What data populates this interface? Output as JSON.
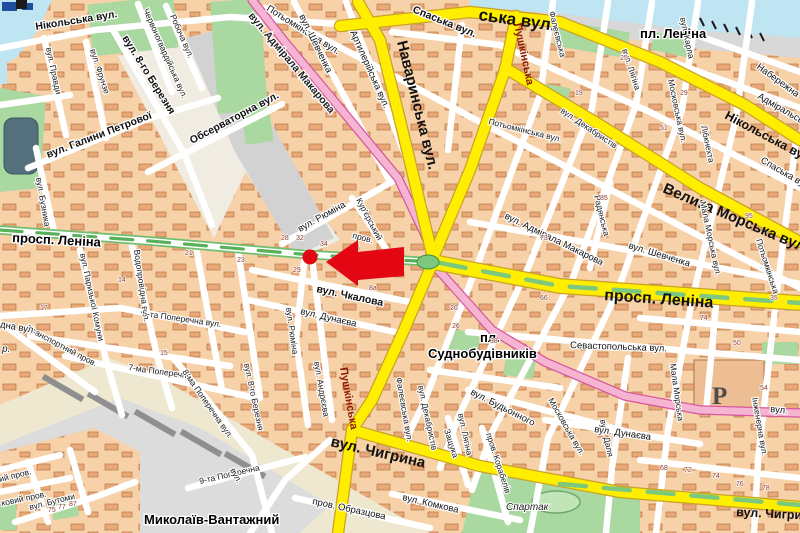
{
  "map_type": "city-street-map",
  "marker": {
    "kind": "red-dot-with-arrow",
    "color": "#E30613",
    "dot": {
      "x": 310,
      "y": 257,
      "r": 7.5
    },
    "arrow_tip": {
      "x": 326,
      "y": 262
    }
  },
  "colors": {
    "road_major": "#FFEE00",
    "road_major_casing": "#C9A227",
    "road_pink": "#F5B5D2",
    "road_pink_casing": "#D6579E",
    "median_green": "#7CC87C",
    "water": "#BFE4F2",
    "park": "#A9D9A0",
    "block": "#F7D1A8",
    "building": "#E8A877",
    "rail_area": "#DCDCDC",
    "marker": "#E30613"
  },
  "major_labels": {
    "navarynska": "Наваринська вул.",
    "nikolska_frag": "ська вул.",
    "nikolska_right": "Нікольська вул.",
    "velyka_morska": "Велика Морська вул.",
    "prospekt_left": "просп. Леніна",
    "prospekt_right": "просп. Леніна",
    "pl_lenina": "пл. Леніна",
    "pl_sudno_line1": "пл.",
    "pl_sudno_line2": "Суднобудівників",
    "chyhryna": "вул. Чигрина",
    "mykolaiv_vantazhnyi": "Миколаїв-Вантажний"
  },
  "labels": [
    {
      "id": "nikolska-left",
      "text": "Нікольська вул.",
      "x": 36,
      "y": 30,
      "r": -9,
      "c": "b"
    },
    {
      "id": "pravdy",
      "text": "вул. Правди",
      "x": 46,
      "y": 48,
      "r": 78,
      "c": "s"
    },
    {
      "id": "frunze",
      "text": "вул. Фрунзе",
      "x": 90,
      "y": 50,
      "r": 72,
      "c": "s"
    },
    {
      "id": "berezni8",
      "text": "вул. 8-го Березня",
      "x": 122,
      "y": 38,
      "r": 58,
      "c": "b"
    },
    {
      "id": "chervonohvardiiska",
      "text": "Червоногвардійська вул.",
      "x": 143,
      "y": 10,
      "r": 66,
      "c": "s"
    },
    {
      "id": "robocha",
      "text": "Робоча вул.",
      "x": 170,
      "y": 16,
      "r": 66,
      "c": "s"
    },
    {
      "id": "halyny-petrovoi",
      "text": "вул. Галини Петрової",
      "x": 48,
      "y": 158,
      "r": -21,
      "c": "b"
    },
    {
      "id": "observatorna",
      "text": "Обсерваторна вул.",
      "x": 192,
      "y": 144,
      "r": -28,
      "c": "b"
    },
    {
      "id": "makarova-1",
      "text": "вул. Адмірала Макарова",
      "x": 248,
      "y": 16,
      "r": 50,
      "c": "pink"
    },
    {
      "id": "riumina-1",
      "text": "вул. Рюміна",
      "x": 300,
      "y": 232,
      "r": -29,
      "c": "m"
    },
    {
      "id": "kurierskyi",
      "text": "Кур'єрський",
      "x": 356,
      "y": 200,
      "r": 62,
      "c": "s"
    },
    {
      "id": "kurierskyi-prov",
      "text": "пров.",
      "x": 352,
      "y": 238,
      "r": 14,
      "c": "s"
    },
    {
      "id": "chkalova",
      "text": "вул. Чкалова",
      "x": 316,
      "y": 292,
      "r": 12,
      "c": "b"
    },
    {
      "id": "potyomkinska-nw",
      "text": "Потьомкінська вул.",
      "x": 266,
      "y": 10,
      "r": 32,
      "c": "m"
    },
    {
      "id": "shevchenka-1",
      "text": "вул. Шевченка",
      "x": 299,
      "y": 16,
      "r": 64,
      "c": "m"
    },
    {
      "id": "artyleriiska",
      "text": "Артилерійська вул.",
      "x": 350,
      "y": 32,
      "r": 66,
      "c": "m"
    },
    {
      "id": "spaska-1",
      "text": "Спаська вул.",
      "x": 412,
      "y": 12,
      "r": 22,
      "c": "b"
    },
    {
      "id": "pushkinska-n",
      "text": "Пушкінська",
      "x": 514,
      "y": 24,
      "r": 78,
      "c": "red"
    },
    {
      "id": "faleievska-1",
      "text": "Фалеєвська",
      "x": 549,
      "y": 12,
      "r": 76,
      "c": "s"
    },
    {
      "id": "liahina-1",
      "text": "вул. Лягіна",
      "x": 622,
      "y": 50,
      "r": 72,
      "c": "s"
    },
    {
      "id": "dekabrystiv-1",
      "text": "вул. Декабристів",
      "x": 560,
      "y": 112,
      "r": 34,
      "c": "s"
    },
    {
      "id": "moskovska-1",
      "text": "Московська вул.",
      "x": 668,
      "y": 80,
      "r": 78,
      "c": "s"
    },
    {
      "id": "karla",
      "text": "вул. Карла",
      "x": 680,
      "y": 18,
      "r": 78,
      "c": "s"
    },
    {
      "id": "libknekhta",
      "text": "Лібкнехта",
      "x": 701,
      "y": 126,
      "r": 78,
      "c": "s"
    },
    {
      "id": "naberezhna",
      "text": "Набережна",
      "x": 756,
      "y": 68,
      "r": 36,
      "c": "m"
    },
    {
      "id": "admiralska",
      "text": "Адміральська",
      "x": 757,
      "y": 98,
      "r": 30,
      "c": "m"
    },
    {
      "id": "spaska-r",
      "text": "Спаська вул.",
      "x": 760,
      "y": 162,
      "r": 30,
      "c": "m"
    },
    {
      "id": "potyomkinska-mid",
      "text": "Потьомкінська вул.",
      "x": 488,
      "y": 124,
      "r": 14,
      "c": "s"
    },
    {
      "id": "potyomkinska-r",
      "text": "Потьомкінська",
      "x": 756,
      "y": 240,
      "r": 72,
      "c": "s"
    },
    {
      "id": "radianska",
      "text": "Радянська",
      "x": 594,
      "y": 196,
      "r": 76,
      "c": "s"
    },
    {
      "id": "shevchenka-2",
      "text": "вул. Шевченка",
      "x": 628,
      "y": 248,
      "r": 17,
      "c": "m"
    },
    {
      "id": "makarova-2",
      "text": "вул. Адмірала Макарова",
      "x": 504,
      "y": 218,
      "r": 26,
      "c": "m"
    },
    {
      "id": "mala-morska-1",
      "text": "Мала Морська вул.",
      "x": 700,
      "y": 202,
      "r": 78,
      "c": "s"
    },
    {
      "id": "sevastopolska",
      "text": "Севастопольська вул.",
      "x": 570,
      "y": 348,
      "r": 2,
      "c": "m"
    },
    {
      "id": "vodoprovidna",
      "text": "Водопровідна вул.",
      "x": 134,
      "y": 250,
      "r": 82,
      "c": "s"
    },
    {
      "id": "paryzkoi-komuny",
      "text": "вул. Паризької Комуни",
      "x": 80,
      "y": 254,
      "r": 78,
      "c": "s"
    },
    {
      "id": "buznyka",
      "text": "вул. Бузника",
      "x": 36,
      "y": 178,
      "r": 80,
      "c": "s"
    },
    {
      "id": "riumina-2",
      "text": "вул. Рюміна",
      "x": 286,
      "y": 308,
      "r": 82,
      "c": "s"
    },
    {
      "id": "dunaieva-1",
      "text": "вул. Дунаєва",
      "x": 300,
      "y": 314,
      "r": 13,
      "c": "m"
    },
    {
      "id": "transportnyi",
      "text": "Транспортний пров.",
      "x": 26,
      "y": 330,
      "r": 28,
      "c": "s"
    },
    {
      "id": "zakhidna",
      "text": "Західна вул.",
      "x": -18,
      "y": 324,
      "r": 10,
      "c": "m"
    },
    {
      "id": "richka",
      "text": "р.",
      "x": 2,
      "y": 352,
      "r": 0,
      "c": "it"
    },
    {
      "id": "poperechna-5",
      "text": "5-та Поперечна вул.",
      "x": 142,
      "y": 316,
      "r": 8,
      "c": "s"
    },
    {
      "id": "poperechna-7",
      "text": "7-ма Поперечна",
      "x": 128,
      "y": 370,
      "r": 8,
      "c": "s"
    },
    {
      "id": "poperechna-8",
      "text": "8-ма Поперечна вул.",
      "x": 182,
      "y": 372,
      "r": 55,
      "c": "s"
    },
    {
      "id": "poperechna-9",
      "text": "9-та Поперечна",
      "x": 200,
      "y": 484,
      "r": -13,
      "c": "s"
    },
    {
      "id": "poperechna-9-vul",
      "text": "вул.",
      "x": 230,
      "y": 470,
      "r": 62,
      "c": "s"
    },
    {
      "id": "berezni8-s",
      "text": "вул. 8-го Березня",
      "x": 244,
      "y": 364,
      "r": 78,
      "c": "s"
    },
    {
      "id": "butomy",
      "text": "вул. Бутоми",
      "x": 30,
      "y": 510,
      "r": -14,
      "c": "s"
    },
    {
      "id": "prov-frag-1",
      "text": "ий пров.",
      "x": 0,
      "y": 482,
      "r": -14,
      "c": "s"
    },
    {
      "id": "prov-frag-2",
      "text": "ковий пров.",
      "x": 2,
      "y": 506,
      "r": -12,
      "c": "s"
    },
    {
      "id": "pushkinska-s",
      "text": "Пушкінська",
      "x": 340,
      "y": 368,
      "r": 80,
      "c": "red"
    },
    {
      "id": "andrieieva",
      "text": "вул. Андрєєва",
      "x": 314,
      "y": 362,
      "r": 80,
      "c": "s"
    },
    {
      "id": "faleievska-2",
      "text": "Фалеєвська вул.",
      "x": 396,
      "y": 378,
      "r": 80,
      "c": "s"
    },
    {
      "id": "dekabrystiv-2",
      "text": "вул. Декабристів",
      "x": 418,
      "y": 386,
      "r": 78,
      "c": "s"
    },
    {
      "id": "zashchuka",
      "text": "Защука",
      "x": 444,
      "y": 430,
      "r": 72,
      "c": "s"
    },
    {
      "id": "liahina-2",
      "text": "вул. Лягіна",
      "x": 458,
      "y": 414,
      "r": 78,
      "c": "s"
    },
    {
      "id": "budonnoho",
      "text": "вул. Будьонного",
      "x": 470,
      "y": 394,
      "r": 27,
      "c": "m"
    },
    {
      "id": "korabeliv",
      "text": "пров. Корабелів",
      "x": 486,
      "y": 434,
      "r": 72,
      "c": "s"
    },
    {
      "id": "obraztsova",
      "text": "пров. Образцова",
      "x": 312,
      "y": 504,
      "r": 12,
      "c": "m"
    },
    {
      "id": "komkova",
      "text": "вул. Комкова",
      "x": 402,
      "y": 500,
      "r": 13,
      "c": "m"
    },
    {
      "id": "spartak",
      "text": "Спартак",
      "x": 506,
      "y": 510,
      "r": 0,
      "c": "it"
    },
    {
      "id": "moskovska-2",
      "text": "Московська вул.",
      "x": 548,
      "y": 400,
      "r": 60,
      "c": "s"
    },
    {
      "id": "dalia",
      "text": "вул. Даля",
      "x": 600,
      "y": 420,
      "r": 78,
      "c": "s"
    },
    {
      "id": "dunaieva-2",
      "text": "вул. Дунаєва",
      "x": 594,
      "y": 432,
      "r": 8,
      "c": "m"
    },
    {
      "id": "mala-morska-2",
      "text": "Мала Морська",
      "x": 670,
      "y": 364,
      "r": 82,
      "c": "s"
    },
    {
      "id": "inzhenerna",
      "text": "Інженерна вул.",
      "x": 752,
      "y": 398,
      "r": 80,
      "c": "s"
    },
    {
      "id": "vul-frag-r",
      "text": "вул.",
      "x": 770,
      "y": 412,
      "r": 5,
      "c": "m"
    },
    {
      "id": "chyhryna-2",
      "text": "вул. Чигрина",
      "x": 736,
      "y": 516,
      "r": 3,
      "c": "rd"
    },
    {
      "id": "parking",
      "text": "Р",
      "x": 712,
      "y": 404,
      "r": 0,
      "c": "pk"
    }
  ],
  "house_numbers": [
    {
      "t": "28",
      "x": 281,
      "y": 240
    },
    {
      "t": "32",
      "x": 296,
      "y": 240
    },
    {
      "t": "34",
      "x": 320,
      "y": 246
    },
    {
      "t": "29",
      "x": 293,
      "y": 272
    },
    {
      "t": "86",
      "x": 352,
      "y": 250
    },
    {
      "t": "8а",
      "x": 369,
      "y": 290
    },
    {
      "t": "21",
      "x": 185,
      "y": 255
    },
    {
      "t": "23",
      "x": 237,
      "y": 262
    },
    {
      "t": "14",
      "x": 118,
      "y": 282
    },
    {
      "t": "17",
      "x": 40,
      "y": 310
    },
    {
      "t": "15",
      "x": 160,
      "y": 355
    },
    {
      "t": "20",
      "x": 450,
      "y": 310
    },
    {
      "t": "26",
      "x": 452,
      "y": 328
    },
    {
      "t": "38",
      "x": 490,
      "y": 343
    },
    {
      "t": "66",
      "x": 540,
      "y": 300
    },
    {
      "t": "74",
      "x": 700,
      "y": 320
    },
    {
      "t": "50",
      "x": 733,
      "y": 345
    },
    {
      "t": "54",
      "x": 760,
      "y": 390
    },
    {
      "t": "68",
      "x": 660,
      "y": 470
    },
    {
      "t": "72",
      "x": 684,
      "y": 472
    },
    {
      "t": "74",
      "x": 712,
      "y": 478
    },
    {
      "t": "76",
      "x": 736,
      "y": 486
    },
    {
      "t": "78",
      "x": 762,
      "y": 490
    },
    {
      "t": "75",
      "x": 48,
      "y": 512
    },
    {
      "t": "77",
      "x": 58,
      "y": 509
    },
    {
      "t": "87",
      "x": 69,
      "y": 506
    },
    {
      "t": "73",
      "x": 540,
      "y": 240
    },
    {
      "t": "85",
      "x": 600,
      "y": 200
    },
    {
      "t": "51",
      "x": 660,
      "y": 130
    },
    {
      "t": "19",
      "x": 575,
      "y": 95
    },
    {
      "t": "25",
      "x": 620,
      "y": 60
    },
    {
      "t": "29",
      "x": 680,
      "y": 95
    },
    {
      "t": "95",
      "x": 745,
      "y": 218
    },
    {
      "t": "35",
      "x": 770,
      "y": 300
    }
  ]
}
